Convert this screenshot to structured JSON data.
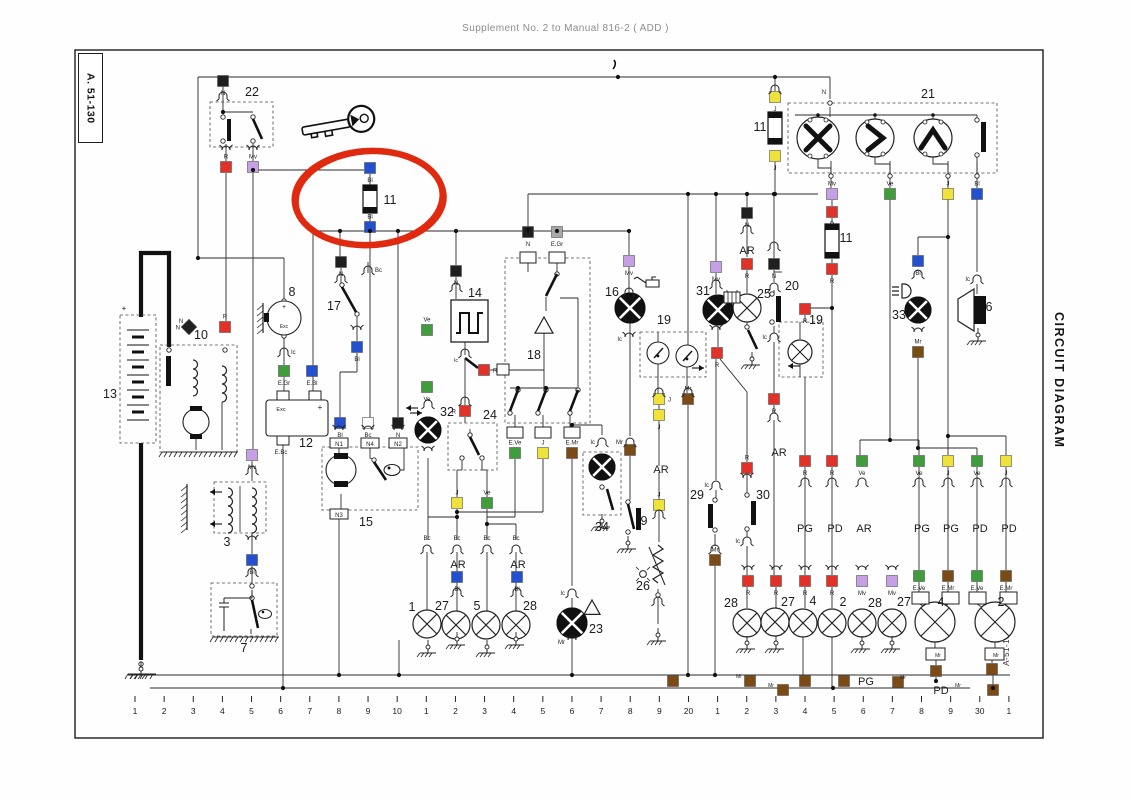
{
  "header": {
    "title": "Supplement No. 2 to Manual 816-2 ( ADD )"
  },
  "labels": {
    "corner": "A. 51-130",
    "side": "CIRCUIT DIAGRAM",
    "inner_side": "A-51-130"
  },
  "palette": {
    "N": "#1f1f1f",
    "R": "#e23127",
    "Bl": "#2350cf",
    "Ve": "#3f9e3b",
    "J": "#efe23b",
    "Mv": "#c79fe4",
    "Mr": "#7c4a15",
    "Bc": "#fdfdfd",
    "Gr": "#a8a8a8"
  },
  "marker": {
    "color": "#e02a10",
    "cx": 369,
    "cy": 198,
    "rx": 74,
    "ry": 47
  },
  "axis": {
    "labels": [
      "1",
      "2",
      "3",
      "4",
      "5",
      "6",
      "7",
      "8",
      "9",
      "10",
      "1",
      "2",
      "3",
      "4",
      "5",
      "6",
      "7",
      "8",
      "9",
      "20",
      "1",
      "2",
      "3",
      "4",
      "5",
      "6",
      "7",
      "8",
      "9",
      "30",
      "1"
    ]
  },
  "squares": [
    [
      223,
      81,
      "N",
      "N",
      "b"
    ],
    [
      226,
      167,
      "R",
      "R",
      "a"
    ],
    [
      253,
      167,
      "Mv",
      "Mv",
      "a"
    ],
    [
      370,
      168,
      "Bl",
      "Bl",
      "b"
    ],
    [
      370,
      227,
      "Bl",
      "Bl",
      "a"
    ],
    [
      775,
      97,
      "J",
      "J",
      "b"
    ],
    [
      775,
      156,
      "J",
      "J",
      "b"
    ],
    [
      832,
      194,
      "Mv",
      "Mv",
      "a"
    ],
    [
      890,
      194,
      "Ve",
      "Ve",
      "a"
    ],
    [
      948,
      194,
      "J",
      "J",
      "a"
    ],
    [
      977,
      194,
      "Bl",
      "Bl",
      "a"
    ],
    [
      832,
      212,
      "R",
      "R",
      "b"
    ],
    [
      832,
      269,
      "R",
      "R",
      "b"
    ],
    [
      747,
      213,
      "N",
      "N",
      "b"
    ],
    [
      747,
      264,
      "R",
      "R",
      "b"
    ],
    [
      774,
      264,
      "N",
      "N",
      "b"
    ],
    [
      629,
      261,
      "Mv",
      "Mv",
      "b"
    ],
    [
      716,
      267,
      "Mv",
      "Mv",
      "b"
    ],
    [
      805,
      309,
      "R",
      "R",
      "b"
    ],
    [
      918,
      261,
      "Bl",
      "Bl",
      "b"
    ],
    [
      717,
      353,
      "R",
      "R",
      "b"
    ],
    [
      774,
      399,
      "R",
      "R",
      "b"
    ],
    [
      659,
      399,
      "J",
      "J",
      "r"
    ],
    [
      659,
      415,
      "J",
      "J",
      "b"
    ],
    [
      688,
      399,
      "Mr",
      "Mr",
      "a"
    ],
    [
      630,
      450,
      "Mr",
      "",
      "b"
    ],
    [
      528,
      232,
      "N",
      "N",
      "b"
    ],
    [
      557,
      232,
      "Gr",
      "E.Gr",
      "b"
    ],
    [
      515,
      453,
      "Ve",
      "E.Ve",
      "a"
    ],
    [
      543,
      453,
      "J",
      "J",
      "a"
    ],
    [
      572,
      453,
      "Mr",
      "E.Mr",
      "a"
    ],
    [
      456,
      271,
      "N",
      "N",
      "b"
    ],
    [
      427,
      330,
      "Ve",
      "Ve",
      "a"
    ],
    [
      427,
      387,
      "Ve",
      "Ve",
      "b"
    ],
    [
      484,
      370,
      "R",
      "R",
      "r"
    ],
    [
      465,
      411,
      "R",
      "R",
      "l"
    ],
    [
      341,
      262,
      "N",
      "N",
      "b"
    ],
    [
      357,
      347,
      "Bl",
      "Bl",
      "b"
    ],
    [
      340,
      423,
      "Bl",
      "Bl",
      "b"
    ],
    [
      368,
      423,
      "Bc",
      "Bc",
      "b"
    ],
    [
      398,
      423,
      "N",
      "N",
      "b"
    ],
    [
      284,
      371,
      "Ve",
      "E.Gr",
      "b"
    ],
    [
      312,
      371,
      "Bl",
      "E.Bl",
      "b"
    ],
    [
      252,
      455,
      "Mv",
      "Mv",
      "b"
    ],
    [
      252,
      560,
      "Bl",
      "Bl",
      "b"
    ],
    [
      457,
      503,
      "J",
      "J",
      "a"
    ],
    [
      487,
      503,
      "Ve",
      "Ve",
      "a"
    ],
    [
      457,
      577,
      "Bl",
      "Bl",
      "b"
    ],
    [
      517,
      577,
      "Bl",
      "Bl",
      "b"
    ],
    [
      659,
      505,
      "J",
      "J",
      "a"
    ],
    [
      715,
      560,
      "Mr",
      "Mr",
      "a"
    ],
    [
      747,
      468,
      "R",
      "R",
      "a"
    ],
    [
      805,
      461,
      "R",
      "R",
      "b"
    ],
    [
      832,
      461,
      "R",
      "R",
      "b"
    ],
    [
      862,
      461,
      "Ve",
      "Ve",
      "b"
    ],
    [
      919,
      461,
      "Ve",
      "Ve",
      "b"
    ],
    [
      948,
      461,
      "J",
      "J",
      "b"
    ],
    [
      977,
      461,
      "Ve",
      "Ve",
      "b"
    ],
    [
      1006,
      461,
      "J",
      "J",
      "b"
    ],
    [
      748,
      581,
      "R",
      "R",
      "b"
    ],
    [
      776,
      581,
      "R",
      "R",
      "b"
    ],
    [
      805,
      581,
      "R",
      "R",
      "b"
    ],
    [
      832,
      581,
      "R",
      "R",
      "b"
    ],
    [
      862,
      581,
      "Mv",
      "Mv",
      "b"
    ],
    [
      892,
      581,
      "Mv",
      "Mv",
      "b"
    ],
    [
      919,
      576,
      "Ve",
      "E.Ve",
      "b"
    ],
    [
      948,
      576,
      "Mr",
      "E.Mr",
      "b"
    ],
    [
      977,
      576,
      "Ve",
      "E.Ve",
      "b"
    ],
    [
      1006,
      576,
      "Mr",
      "E.Mr",
      "b"
    ],
    [
      936,
      671,
      "Mr",
      "",
      ""
    ],
    [
      992,
      669,
      "Mr",
      "",
      ""
    ],
    [
      918,
      352,
      "Mr",
      "Mr",
      "a"
    ],
    [
      225,
      327,
      "R",
      "R",
      "a"
    ],
    [
      750,
      681,
      "Mr",
      "",
      ""
    ],
    [
      783,
      690,
      "Mr",
      "",
      ""
    ],
    [
      805,
      681,
      "Mr",
      "",
      ""
    ],
    [
      844,
      681,
      "Mr",
      "",
      ""
    ],
    [
      898,
      682,
      "Mr",
      "",
      ""
    ],
    [
      993,
      690,
      "Mr",
      "",
      ""
    ],
    [
      673,
      681,
      "Mr",
      "",
      ""
    ]
  ],
  "diag_squares": [
    [
      189,
      327,
      "N",
      "N",
      "l"
    ]
  ],
  "plugs": [
    [
      223,
      95,
      0,
      "",
      ""
    ],
    [
      226,
      151,
      1,
      "",
      ""
    ],
    [
      253,
      151,
      1,
      "",
      ""
    ],
    [
      341,
      277,
      0,
      "",
      ""
    ],
    [
      368,
      269,
      0,
      "Bc",
      "r"
    ],
    [
      357,
      331,
      1,
      "",
      ""
    ],
    [
      284,
      351,
      0,
      "Ic",
      "r"
    ],
    [
      252,
      469,
      0,
      "",
      ""
    ],
    [
      252,
      541,
      1,
      "",
      ""
    ],
    [
      252,
      571,
      0,
      "",
      ""
    ],
    [
      456,
      286,
      0,
      "",
      ""
    ],
    [
      465,
      352,
      0,
      "",
      ""
    ],
    [
      465,
      400,
      0,
      "",
      ""
    ],
    [
      428,
      403,
      0,
      "",
      ""
    ],
    [
      428,
      452,
      1,
      "",
      ""
    ],
    [
      427,
      548,
      0,
      "Bc",
      "a"
    ],
    [
      457,
      548,
      0,
      "Bc",
      "a"
    ],
    [
      487,
      548,
      0,
      "Bc",
      "a"
    ],
    [
      516,
      548,
      0,
      "Bc",
      "a"
    ],
    [
      457,
      591,
      0,
      "",
      ""
    ],
    [
      517,
      591,
      0,
      "",
      ""
    ],
    [
      572,
      592,
      0,
      "Ic",
      "l"
    ],
    [
      572,
      641,
      1,
      "Mr",
      "l"
    ],
    [
      629,
      291,
      0,
      "",
      ""
    ],
    [
      629,
      338,
      1,
      "Ic",
      "l"
    ],
    [
      630,
      441,
      0,
      "Mr",
      "l"
    ],
    [
      659,
      391,
      0,
      "",
      ""
    ],
    [
      659,
      513,
      0,
      "",
      ""
    ],
    [
      688,
      391,
      0,
      "",
      ""
    ],
    [
      716,
      283,
      0,
      "",
      ""
    ],
    [
      716,
      331,
      1,
      "",
      ""
    ],
    [
      716,
      484,
      0,
      "Ic",
      "l"
    ],
    [
      715,
      548,
      0,
      "",
      ""
    ],
    [
      747,
      228,
      0,
      "",
      ""
    ],
    [
      747,
      479,
      1,
      "",
      ""
    ],
    [
      747,
      540,
      0,
      "Ic",
      "l"
    ],
    [
      774,
      245,
      0,
      "",
      ""
    ],
    [
      774,
      286,
      0,
      "",
      ""
    ],
    [
      774,
      336,
      0,
      "Ic",
      "l"
    ],
    [
      774,
      416,
      0,
      "",
      ""
    ],
    [
      805,
      481,
      0,
      "",
      ""
    ],
    [
      832,
      481,
      0,
      "",
      ""
    ],
    [
      862,
      481,
      0,
      "",
      ""
    ],
    [
      919,
      481,
      0,
      "",
      ""
    ],
    [
      948,
      481,
      0,
      "",
      ""
    ],
    [
      977,
      481,
      0,
      "",
      ""
    ],
    [
      1006,
      481,
      0,
      "",
      ""
    ],
    [
      748,
      571,
      1,
      "",
      ""
    ],
    [
      776,
      571,
      1,
      "",
      ""
    ],
    [
      805,
      571,
      1,
      "",
      ""
    ],
    [
      832,
      571,
      1,
      "",
      ""
    ],
    [
      862,
      571,
      1,
      "",
      ""
    ],
    [
      892,
      571,
      1,
      "",
      ""
    ],
    [
      918,
      273,
      0,
      "",
      ""
    ],
    [
      918,
      333,
      1,
      "",
      ""
    ],
    [
      977,
      278,
      0,
      "Ic",
      "l"
    ],
    [
      602,
      441,
      0,
      "Ic",
      "l"
    ],
    [
      339,
      431,
      1,
      "",
      ""
    ],
    [
      368,
      431,
      1,
      "",
      ""
    ],
    [
      398,
      431,
      1,
      "",
      ""
    ],
    [
      775,
      88,
      0,
      "",
      ""
    ],
    [
      658,
      600,
      0,
      "",
      ""
    ]
  ],
  "comp_nums": [
    [
      252,
      96,
      "22"
    ],
    [
      928,
      98,
      "21"
    ],
    [
      390,
      204,
      "11"
    ],
    [
      760,
      131,
      "11"
    ],
    [
      846,
      242,
      "11"
    ],
    [
      110,
      398,
      "13"
    ],
    [
      201,
      339,
      "10"
    ],
    [
      292,
      296,
      "8"
    ],
    [
      334,
      310,
      "17"
    ],
    [
      306,
      447,
      "12"
    ],
    [
      366,
      526,
      "15"
    ],
    [
      227,
      546,
      "3"
    ],
    [
      244,
      652,
      "7"
    ],
    [
      475,
      297,
      "14"
    ],
    [
      534,
      359,
      "18"
    ],
    [
      490,
      419,
      "24"
    ],
    [
      447,
      416,
      "32"
    ],
    [
      612,
      296,
      "16"
    ],
    [
      664,
      324,
      "19"
    ],
    [
      703,
      295,
      "31"
    ],
    [
      764,
      298,
      "25"
    ],
    [
      792,
      290,
      "20"
    ],
    [
      816,
      324,
      "19"
    ],
    [
      899,
      319,
      "33"
    ],
    [
      989,
      311,
      "6"
    ],
    [
      596,
      633,
      "23"
    ],
    [
      643,
      590,
      "26"
    ],
    [
      602,
      531,
      "34"
    ],
    [
      644,
      525,
      "9"
    ],
    [
      697,
      499,
      "29"
    ],
    [
      763,
      499,
      "30"
    ],
    [
      412,
      611,
      "1"
    ],
    [
      442,
      610,
      "27"
    ],
    [
      477,
      610,
      "5"
    ],
    [
      530,
      610,
      "28"
    ],
    [
      731,
      607,
      "28"
    ],
    [
      788,
      606,
      "27"
    ],
    [
      813,
      605,
      "4"
    ],
    [
      843,
      606,
      "2"
    ],
    [
      875,
      607,
      "28"
    ],
    [
      904,
      606,
      "27"
    ],
    [
      941,
      606,
      "4"
    ],
    [
      1001,
      606,
      "2"
    ]
  ],
  "misc_labels": [
    [
      747,
      254,
      "AR",
      11
    ],
    [
      779,
      456,
      "AR",
      11
    ],
    [
      661,
      473,
      "AR",
      11
    ],
    [
      458,
      568,
      "AR",
      11
    ],
    [
      518,
      568,
      "AR",
      11
    ],
    [
      805,
      532,
      "PG",
      11
    ],
    [
      835,
      532,
      "PD",
      11
    ],
    [
      864,
      532,
      "AR",
      11
    ],
    [
      922,
      532,
      "PG",
      11
    ],
    [
      951,
      532,
      "PG",
      11
    ],
    [
      980,
      532,
      "PD",
      11
    ],
    [
      1009,
      532,
      "PD",
      11
    ],
    [
      866,
      685,
      "PG",
      11
    ],
    [
      941,
      694,
      "PD",
      11
    ],
    [
      739,
      678,
      "Mr",
      5
    ],
    [
      771,
      687,
      "Mr",
      5
    ],
    [
      903,
      679,
      "Mr",
      5
    ],
    [
      958,
      687,
      "Mr",
      5
    ],
    [
      281,
      454,
      "E.Bc",
      6
    ],
    [
      284,
      309,
      "+",
      7
    ],
    [
      284,
      328,
      "Exc",
      5
    ],
    [
      281,
      411,
      "Exc",
      5.5
    ],
    [
      320,
      410,
      "+",
      8
    ],
    [
      124,
      311,
      "+",
      8
    ],
    [
      181,
      323,
      "N",
      6
    ],
    [
      824,
      94,
      "N",
      6
    ],
    [
      938,
      657,
      "Mr",
      5
    ],
    [
      996,
      657,
      "Mr",
      5
    ],
    [
      456,
      362,
      "Ic",
      5.5
    ],
    [
      341,
      437,
      "N1",
      0
    ],
    [
      371,
      437,
      "N4",
      0
    ],
    [
      399,
      437,
      "N2",
      0
    ]
  ],
  "term_boxes": [
    [
      330,
      438,
      18,
      10,
      "N1"
    ],
    [
      361,
      438,
      18,
      10,
      "N4"
    ],
    [
      389,
      438,
      18,
      10,
      "N2"
    ],
    [
      330,
      509,
      18,
      10,
      "N3"
    ],
    [
      520,
      252,
      16,
      11,
      ""
    ],
    [
      549,
      252,
      16,
      11,
      ""
    ],
    [
      497,
      364,
      12,
      11,
      ""
    ],
    [
      507,
      427,
      16,
      11,
      ""
    ],
    [
      535,
      427,
      16,
      11,
      ""
    ],
    [
      564,
      427,
      16,
      11,
      ""
    ],
    [
      912,
      592,
      17,
      12,
      ""
    ],
    [
      942,
      592,
      17,
      12,
      ""
    ],
    [
      969,
      592,
      17,
      12,
      ""
    ],
    [
      1000,
      592,
      17,
      12,
      ""
    ],
    [
      926,
      648,
      19,
      12,
      ""
    ],
    [
      985,
      648,
      19,
      12,
      ""
    ],
    [
      277,
      391,
      12,
      9,
      ""
    ],
    [
      309,
      391,
      12,
      9,
      ""
    ],
    [
      277,
      436,
      12,
      9,
      ""
    ]
  ],
  "lamps_x": [
    [
      427,
      624,
      14
    ],
    [
      456,
      625,
      14
    ],
    [
      486,
      625,
      14
    ],
    [
      516,
      625,
      14
    ],
    [
      747,
      623,
      14
    ],
    [
      775,
      622,
      14
    ],
    [
      803,
      623,
      14
    ],
    [
      832,
      623,
      14
    ],
    [
      862,
      623,
      14
    ],
    [
      892,
      623,
      14
    ],
    [
      747,
      308,
      14
    ],
    [
      800,
      352,
      12
    ],
    [
      935,
      622,
      20
    ],
    [
      995,
      622,
      20
    ]
  ],
  "lamps_q": [
    [
      630,
      308,
      15
    ],
    [
      718,
      310,
      15
    ],
    [
      572,
      623,
      15
    ],
    [
      602,
      467,
      13
    ],
    [
      428,
      430,
      13
    ],
    [
      918,
      310,
      13
    ]
  ],
  "gauges": [
    [
      658,
      353,
      11
    ],
    [
      687,
      356,
      11
    ]
  ],
  "motors21": [
    [
      818,
      138,
      21,
      "X"
    ],
    [
      875,
      138,
      19,
      ">"
    ],
    [
      933,
      138,
      19,
      "^"
    ]
  ],
  "grounds": [
    [
      428,
      640
    ],
    [
      457,
      632
    ],
    [
      487,
      640
    ],
    [
      516,
      632
    ],
    [
      747,
      636
    ],
    [
      776,
      636
    ],
    [
      862,
      636
    ],
    [
      892,
      636
    ],
    [
      602,
      514
    ],
    [
      628,
      536
    ],
    [
      658,
      628
    ],
    [
      978,
      328
    ],
    [
      141,
      662
    ],
    [
      752,
      352
    ]
  ],
  "hatch_bars": [
    [
      162,
      452,
      76
    ],
    [
      213,
      637,
      66
    ],
    [
      128,
      674,
      28
    ],
    [
      162,
      452,
      0
    ]
  ],
  "fuses": [
    [
      363,
      185,
      14,
      28
    ],
    [
      768,
      112,
      14,
      32
    ],
    [
      825,
      224,
      14,
      34
    ]
  ]
}
